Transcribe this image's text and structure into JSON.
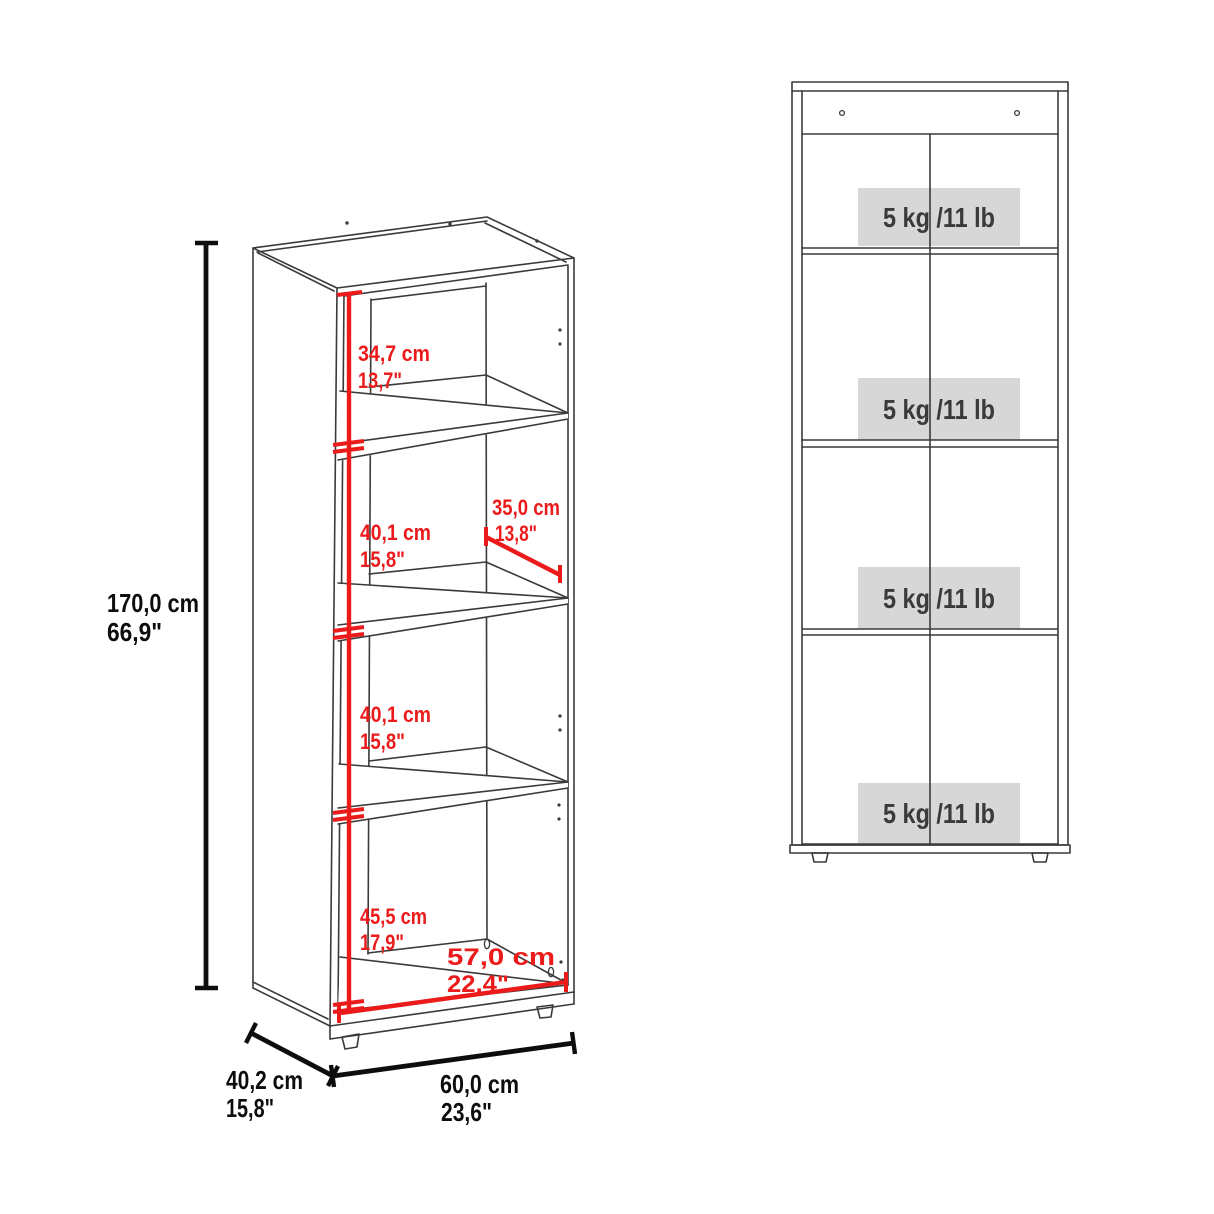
{
  "perspective_view": {
    "overall_height": {
      "cm": "170,0 cm",
      "inch": "66,9\""
    },
    "overall_depth": {
      "cm": "40,2 cm",
      "inch": "15,8\""
    },
    "overall_width": {
      "cm": "60,0 cm",
      "inch": "23,6\""
    },
    "compartment_1_height": {
      "cm": "34,7 cm",
      "inch": "13,7\""
    },
    "compartment_2_height": {
      "cm": "40,1 cm",
      "inch": "15,8\""
    },
    "shelf_depth": {
      "cm": "35,0 cm",
      "inch": "13,8\""
    },
    "compartment_3_height": {
      "cm": "40,1 cm",
      "inch": "15,8\""
    },
    "compartment_4_height": {
      "cm": "45,5 cm",
      "inch": "17,9\""
    },
    "inner_width": {
      "cm": "57,0 cm",
      "inch": "22,4\""
    }
  },
  "front_view": {
    "shelf_labels": [
      {
        "capacity": "5 kg /11 lb"
      },
      {
        "capacity": "5 kg /11 lb"
      },
      {
        "capacity": "5 kg /11 lb"
      },
      {
        "capacity": "5 kg /11 lb"
      }
    ]
  },
  "colors": {
    "dimension_red": "#ec1b1b",
    "drawing_line": "#3a3a3a",
    "dimension_black": "#0d0d0d",
    "capacity_label_bg": "#d7d7d7",
    "capacity_label_text": "#3a3a3a"
  }
}
